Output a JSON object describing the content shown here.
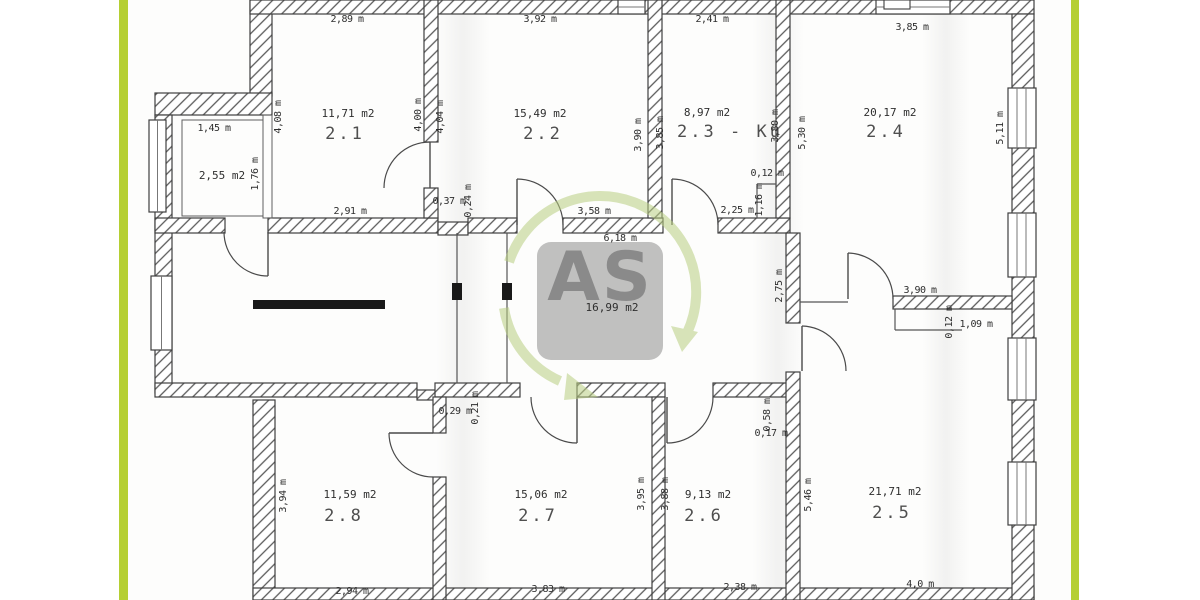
{
  "colors": {
    "stripe": "#b5cf33",
    "line": "#3f3f3f",
    "hatch": "#5a5a5a",
    "black_bar": "#191919",
    "watermark_square": "#8f8f8f",
    "watermark_text": "#fdfdfd",
    "watermark_arrow": "#b9cf82",
    "label": "#2e2e2e"
  },
  "watermark": {
    "text": "AS"
  },
  "rooms": [
    {
      "name": "storage",
      "area": "2,55 m2",
      "number": "",
      "area_pos": [
        222,
        179
      ],
      "num_pos": null
    },
    {
      "name": "room-2-1",
      "area": "11,71 m2",
      "number": "2.1",
      "area_pos": [
        348,
        117
      ],
      "num_pos": [
        345,
        139
      ]
    },
    {
      "name": "room-2-2",
      "area": "15,49 m2",
      "number": "2.2",
      "area_pos": [
        540,
        117
      ],
      "num_pos": [
        543,
        139
      ]
    },
    {
      "name": "room-2-3",
      "area": "8,97 m2",
      "number": "2.3 - Kü",
      "area_pos": [
        707,
        116
      ],
      "num_pos": [
        730,
        137
      ]
    },
    {
      "name": "room-2-4",
      "area": "20,17 m2",
      "number": "2.4",
      "area_pos": [
        890,
        116
      ],
      "num_pos": [
        886,
        137
      ]
    },
    {
      "name": "corridor",
      "area": "16,99 m2",
      "number": "",
      "area_pos": [
        612,
        311
      ],
      "num_pos": null
    },
    {
      "name": "room-2-5",
      "area": "21,71 m2",
      "number": "2.5",
      "area_pos": [
        895,
        495
      ],
      "num_pos": [
        892,
        518
      ]
    },
    {
      "name": "room-2-6",
      "area": "9,13 m2",
      "number": "2.6",
      "area_pos": [
        708,
        498
      ],
      "num_pos": [
        704,
        521
      ]
    },
    {
      "name": "room-2-7",
      "area": "15,06 m2",
      "number": "2.7",
      "area_pos": [
        541,
        498
      ],
      "num_pos": [
        538,
        521
      ]
    },
    {
      "name": "room-2-8",
      "area": "11,59 m2",
      "number": "2.8",
      "area_pos": [
        350,
        498
      ],
      "num_pos": [
        344,
        521
      ]
    }
  ],
  "dimensions": [
    {
      "text": "2,89 m",
      "pos": [
        347,
        22
      ],
      "vertical": false
    },
    {
      "text": "3,92 m",
      "pos": [
        540,
        22
      ],
      "vertical": false
    },
    {
      "text": "2,41 m",
      "pos": [
        712,
        22
      ],
      "vertical": false
    },
    {
      "text": "3,85 m",
      "pos": [
        912,
        30
      ],
      "vertical": false
    },
    {
      "text": "1,45 m",
      "pos": [
        214,
        131
      ],
      "vertical": false
    },
    {
      "text": "2,91 m",
      "pos": [
        350,
        214
      ],
      "vertical": false
    },
    {
      "text": "0,37 m",
      "pos": [
        449,
        204
      ],
      "vertical": false
    },
    {
      "text": "3,58 m",
      "pos": [
        594,
        214
      ],
      "vertical": false
    },
    {
      "text": "6,18 m",
      "pos": [
        620,
        241
      ],
      "vertical": false
    },
    {
      "text": "2,25 m",
      "pos": [
        737,
        213
      ],
      "vertical": false
    },
    {
      "text": "0,12 m",
      "pos": [
        767,
        176
      ],
      "vertical": false
    },
    {
      "text": "3,90 m",
      "pos": [
        920,
        293
      ],
      "vertical": false
    },
    {
      "text": "1,09 m",
      "pos": [
        976,
        327
      ],
      "vertical": false
    },
    {
      "text": "0,29 m",
      "pos": [
        455,
        414
      ],
      "vertical": false
    },
    {
      "text": "0,17 m",
      "pos": [
        771,
        436
      ],
      "vertical": false
    },
    {
      "text": "2,94 m",
      "pos": [
        352,
        594
      ],
      "vertical": false
    },
    {
      "text": "3,83 m",
      "pos": [
        548,
        592
      ],
      "vertical": false
    },
    {
      "text": "2,38 m",
      "pos": [
        740,
        590
      ],
      "vertical": false
    },
    {
      "text": "4,0 m",
      "pos": [
        920,
        587
      ],
      "vertical": false
    },
    {
      "text": "4,08 m",
      "pos": [
        281,
        117
      ],
      "vertical": true
    },
    {
      "text": "1,76 m",
      "pos": [
        258,
        174
      ],
      "vertical": true
    },
    {
      "text": "4,00 m",
      "pos": [
        421,
        115
      ],
      "vertical": true
    },
    {
      "text": "4,04 m",
      "pos": [
        443,
        117
      ],
      "vertical": true
    },
    {
      "text": "3,90 m",
      "pos": [
        641,
        135
      ],
      "vertical": true
    },
    {
      "text": "3,85 m",
      "pos": [
        663,
        133
      ],
      "vertical": true
    },
    {
      "text": "3,80 m",
      "pos": [
        778,
        126
      ],
      "vertical": true
    },
    {
      "text": "5,30 m",
      "pos": [
        805,
        133
      ],
      "vertical": true
    },
    {
      "text": "5,11 m",
      "pos": [
        1003,
        128
      ],
      "vertical": true
    },
    {
      "text": "1,16 m",
      "pos": [
        762,
        200
      ],
      "vertical": true
    },
    {
      "text": "0,24 m",
      "pos": [
        471,
        201
      ],
      "vertical": true
    },
    {
      "text": "2,75 m",
      "pos": [
        782,
        286
      ],
      "vertical": true
    },
    {
      "text": "0,12 m",
      "pos": [
        952,
        322
      ],
      "vertical": true
    },
    {
      "text": "0,21 m",
      "pos": [
        478,
        408
      ],
      "vertical": true
    },
    {
      "text": "0,58 m",
      "pos": [
        770,
        415
      ],
      "vertical": true
    },
    {
      "text": "3,94 m",
      "pos": [
        286,
        496
      ],
      "vertical": true
    },
    {
      "text": "3,95 m",
      "pos": [
        644,
        494
      ],
      "vertical": true
    },
    {
      "text": "3,88 m",
      "pos": [
        668,
        494
      ],
      "vertical": true
    },
    {
      "text": "5,46 m",
      "pos": [
        811,
        495
      ],
      "vertical": true
    }
  ]
}
